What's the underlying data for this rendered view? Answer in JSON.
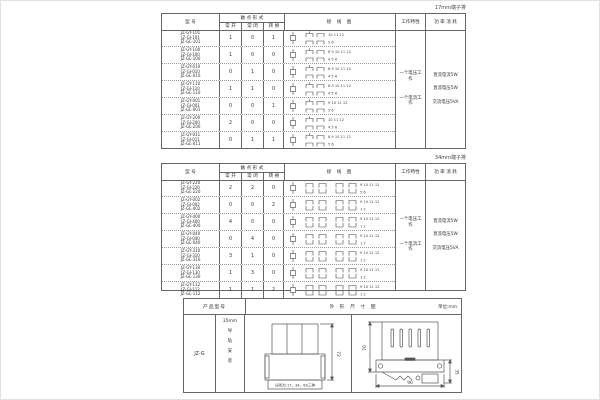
{
  "sections": {
    "table1_label": "17mm端子排",
    "table2_label": "34mm端子排"
  },
  "headers": {
    "model": "型 号",
    "contact_form": "触 点 形 式",
    "normally_open": "常 开",
    "normally_closed": "常 闭",
    "changeover": "转 换",
    "wiring_diagram": "接 线 图",
    "work_characteristic": "工作特性",
    "power_consumption": "功 率 消 耗"
  },
  "work_notes": [
    "一个电压工作",
    "一个电流工作"
  ],
  "power_notes": [
    "直流电流5W",
    "直流电压5W",
    "交流电压5VA"
  ],
  "table1_rows": [
    {
      "models": [
        "JZ-GY-101",
        "JZ-GJ-101",
        "JZ-GL-101"
      ],
      "no": "1",
      "nc": "0",
      "co": "1",
      "top_nums": "10 11 12",
      "bot_nums": "5 6"
    },
    {
      "models": [
        "JZ-GY-100",
        "JZ-GJ-100",
        "JZ-GL-100"
      ],
      "no": "1",
      "nc": "0",
      "co": "0",
      "top_nums": "8 9 10 11 12",
      "bot_nums": "4 5 6"
    },
    {
      "models": [
        "JZ-GY-010",
        "JZ-GJ-010",
        "JZ-GL-010"
      ],
      "no": "0",
      "nc": "1",
      "co": "0",
      "top_nums": "8 9 10 11 12",
      "bot_nums": "4 5 6"
    },
    {
      "models": [
        "JZ-GY-110",
        "JZ-GJ-110",
        "JZ-GL-110"
      ],
      "no": "1",
      "nc": "1",
      "co": "0",
      "top_nums": "8 9 10 11 12",
      "bot_nums": "4 5 6"
    },
    {
      "models": [
        "JZ-GY-001",
        "JZ-GJ-001",
        "JZ-GL-001"
      ],
      "no": "0",
      "nc": "0",
      "co": "1",
      "top_nums": "9 10 11 12",
      "bot_nums": "5 6"
    },
    {
      "models": [
        "JZ-GY-200",
        "JZ-GJ-200",
        "JZ-GL-200"
      ],
      "no": "2",
      "nc": "0",
      "co": "0",
      "top_nums": "10 11 12",
      "bot_nums": "4 5 6"
    },
    {
      "models": [
        "JZ-GY-011",
        "JZ-GJ-011",
        "JZ-GL-011"
      ],
      "no": "0",
      "nc": "1",
      "co": "1",
      "top_nums": "8 9 10 11 12",
      "bot_nums": "5 6"
    }
  ],
  "table2_rows": [
    {
      "models": [
        "JZ-GY-220",
        "JZ-GJ-220",
        "JZ-GL-220"
      ],
      "no": "2",
      "nc": "2",
      "co": "0",
      "top_nums": "9 10 11 12",
      "bot_nums": "5 6"
    },
    {
      "models": [
        "JZ-GY-002",
        "JZ-GJ-002",
        "JZ-GL-002"
      ],
      "no": "0",
      "nc": "0",
      "co": "2",
      "top_nums": "9 10 11 12",
      "bot_nums": "1 2"
    },
    {
      "models": [
        "JZ-GY-400",
        "JZ-GJ-400",
        "JZ-GL-400"
      ],
      "no": "4",
      "nc": "0",
      "co": "0",
      "top_nums": "9 10 11 12",
      "bot_nums": "1 2"
    },
    {
      "models": [
        "JZ-GY-040",
        "JZ-GJ-040",
        "JZ-GL-040"
      ],
      "no": "0",
      "nc": "4",
      "co": "0",
      "top_nums": "9 10 11 12",
      "bot_nums": "1 2"
    },
    {
      "models": [
        "JZ-GY-310",
        "JZ-GJ-310",
        "JZ-GL-310"
      ],
      "no": "3",
      "nc": "1",
      "co": "0",
      "top_nums": "9 10 11 12",
      "bot_nums": "1 2"
    },
    {
      "models": [
        "JZ-GY-130",
        "JZ-GJ-130",
        "JZ-GL-130"
      ],
      "no": "1",
      "nc": "3",
      "co": "0",
      "top_nums": "9 10 11 12",
      "bot_nums": "1 2"
    },
    {
      "models": [
        "JZ-GY-112",
        "JZ-GJ-112",
        "JZ-GL-112"
      ],
      "no": "1",
      "nc": "1",
      "co": "2",
      "top_nums": "9 10 11 12",
      "bot_nums": "1 2"
    }
  ],
  "bottom": {
    "header_left": "产品型号",
    "header_right": "外 形 尺 寸 图",
    "unit": "单位:mm",
    "model": "JZ-G",
    "mount_top": "35mm",
    "mount_chars": [
      "导",
      "轨",
      "安",
      "装"
    ],
    "front_height_dim": "72",
    "front_caption": "分别为:17、34、60三种",
    "side_height_dim": "70",
    "side_depth_dim": "90",
    "side_rail_dim": "35"
  }
}
